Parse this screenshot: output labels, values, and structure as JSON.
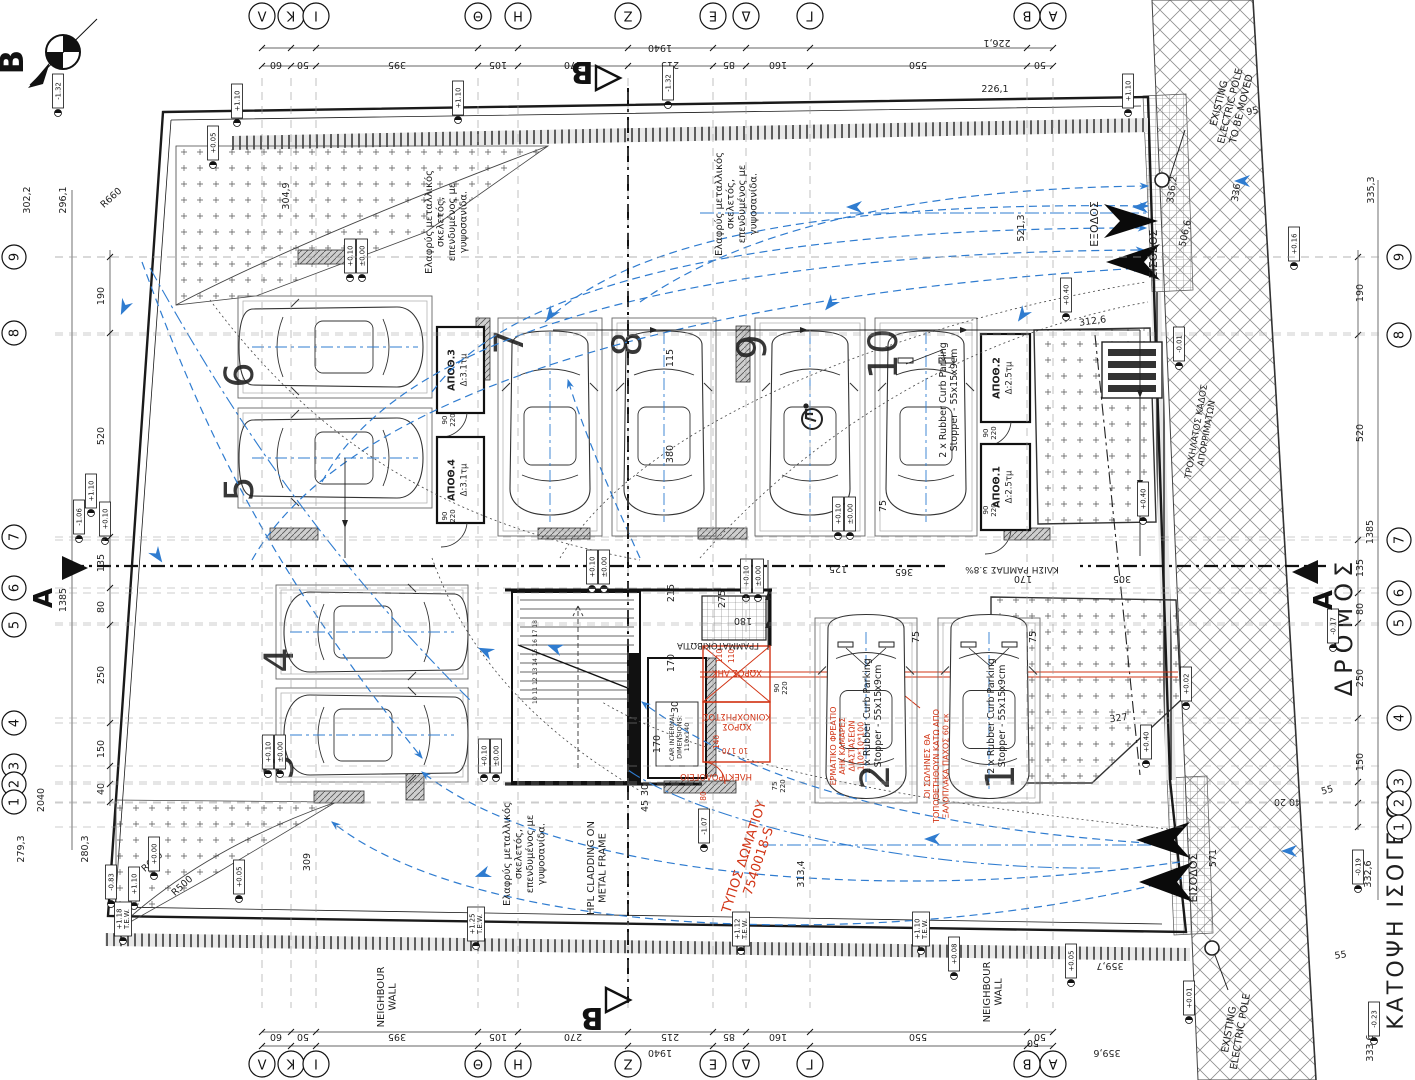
{
  "meta": {
    "drawing_title": "ΚΑΤΟΨΗ ΙΣΟΓΕΙΟΥ",
    "road_label": "ΔΡΟΜΟΣ"
  },
  "colors": {
    "ink": "#1f1f1f",
    "red": "#d23415",
    "blue": "#2f7cd0",
    "gray": "#666666",
    "paper": "#ffffff"
  },
  "markers": {
    "north": "B",
    "section_a": "A",
    "section_b": "B"
  },
  "grid": {
    "cols": [
      {
        "label": "Λ",
        "x": 262
      },
      {
        "label": "K",
        "x": 291
      },
      {
        "label": "I",
        "x": 316
      },
      {
        "label": "Θ",
        "x": 478
      },
      {
        "label": "H",
        "x": 518
      },
      {
        "label": "Z",
        "x": 628
      },
      {
        "label": "E",
        "x": 713
      },
      {
        "label": "Δ",
        "x": 746
      },
      {
        "label": "Γ",
        "x": 810
      },
      {
        "label": "B",
        "x": 1027
      },
      {
        "label": "A",
        "x": 1053
      }
    ],
    "rows_left": [
      {
        "label": "9",
        "y": 257
      },
      {
        "label": "8",
        "y": 333
      },
      {
        "label": "7",
        "y": 537
      },
      {
        "label": "6",
        "y": 588
      },
      {
        "label": "5",
        "y": 625
      },
      {
        "label": "4",
        "y": 723
      },
      {
        "label": "3",
        "y": 766
      },
      {
        "label": "2",
        "y": 784
      },
      {
        "label": "1",
        "y": 802
      }
    ],
    "rows_right": [
      {
        "label": "9",
        "y": 257
      },
      {
        "label": "8",
        "y": 335
      },
      {
        "label": "7",
        "y": 540
      },
      {
        "label": "6",
        "y": 593
      },
      {
        "label": "5",
        "y": 623
      },
      {
        "label": "4",
        "y": 718
      },
      {
        "label": "3",
        "y": 782
      },
      {
        "label": "2",
        "y": 803
      },
      {
        "label": "1",
        "y": 827
      }
    ]
  },
  "rooms": [
    {
      "label": "ΑΠΟΘ.3",
      "area": "Δ:3.1τμ",
      "x": 437,
      "y": 327,
      "w": 47,
      "h": 86
    },
    {
      "label": "ΑΠΟΘ.4",
      "area": "Δ:3.1τμ",
      "x": 437,
      "y": 437,
      "w": 47,
      "h": 86
    },
    {
      "label": "ΑΠΟΘ.2",
      "area": "Δ:2.5τμ",
      "x": 981,
      "y": 334,
      "w": 49,
      "h": 88
    },
    {
      "label": "ΑΠΟΘ.1",
      "area": "Δ:2.5τμ",
      "x": 981,
      "y": 444,
      "w": 49,
      "h": 86
    }
  ],
  "parking": {
    "stopper_note": [
      "2 x Rubber Curb Parking",
      "Stopper - 55x15x9cm"
    ],
    "stoppers": [
      {
        "x": 946,
        "y": 400,
        "cx": 926,
        "cy": 430
      },
      {
        "x": 870,
        "y": 716,
        "cx": 866,
        "cy": 714
      },
      {
        "x": 994,
        "y": 716,
        "cx": 989,
        "cy": 714
      }
    ],
    "spots": [
      {
        "n": "6",
        "x": 238,
        "y": 296,
        "w": 194,
        "h": 102,
        "o": "hl",
        "numx": 253,
        "numy": 375
      },
      {
        "n": "5",
        "x": 238,
        "y": 408,
        "w": 194,
        "h": 100,
        "o": "hl",
        "numx": 253,
        "numy": 489
      },
      {
        "n": "7",
        "x": 498,
        "y": 318,
        "w": 104,
        "h": 218,
        "o": "v",
        "numx": 523,
        "numy": 342
      },
      {
        "n": "8",
        "x": 612,
        "y": 318,
        "w": 104,
        "h": 218,
        "o": "v",
        "numx": 641,
        "numy": 344
      },
      {
        "n": "9",
        "x": 755,
        "y": 318,
        "w": 110,
        "h": 218,
        "o": "v",
        "numx": 766,
        "numy": 347,
        "accessible": true
      },
      {
        "n": "10",
        "x": 875,
        "y": 318,
        "w": 102,
        "h": 218,
        "o": "v",
        "numx": 897,
        "numy": 354
      },
      {
        "n": "4",
        "x": 276,
        "y": 585,
        "w": 192,
        "h": 94,
        "o": "hr",
        "numx": 293,
        "numy": 660
      },
      {
        "n": "3",
        "x": 276,
        "y": 688,
        "w": 192,
        "h": 94,
        "o": "hr",
        "numx": 293,
        "numy": 767
      },
      {
        "n": "2",
        "x": 815,
        "y": 618,
        "w": 102,
        "h": 185,
        "o": "v",
        "numx": 889,
        "numy": 777
      },
      {
        "n": "1",
        "x": 938,
        "y": 618,
        "w": 102,
        "h": 185,
        "o": "v",
        "numx": 1014,
        "numy": 777
      }
    ]
  },
  "flags": [
    {
      "t": "-1.32",
      "x": 58,
      "y": 113
    },
    {
      "t": "-1.32",
      "x": 668,
      "y": 105
    },
    {
      "t": "+1.10",
      "x": 237,
      "y": 123
    },
    {
      "t": "+1.10",
      "x": 458,
      "y": 120
    },
    {
      "t": "+1.10",
      "x": 1128,
      "y": 113
    },
    {
      "t": "+0.05",
      "x": 213,
      "y": 165
    },
    {
      "t": "+0.10",
      "x": 350,
      "y": 278
    },
    {
      "t": "±0.00",
      "x": 362,
      "y": 278
    },
    {
      "t": "+0.10",
      "x": 592,
      "y": 589
    },
    {
      "t": "±0.00",
      "x": 604,
      "y": 589
    },
    {
      "t": "+0.10",
      "x": 746,
      "y": 598
    },
    {
      "t": "±0.00",
      "x": 758,
      "y": 598
    },
    {
      "t": "+0.10",
      "x": 838,
      "y": 536
    },
    {
      "t": "±0.00",
      "x": 850,
      "y": 536
    },
    {
      "t": "+0.10",
      "x": 268,
      "y": 774
    },
    {
      "t": "±0.00",
      "x": 280,
      "y": 774
    },
    {
      "t": "+0.10",
      "x": 484,
      "y": 778
    },
    {
      "t": "±0.00",
      "x": 496,
      "y": 778
    },
    {
      "t": "+0.40",
      "x": 1066,
      "y": 317
    },
    {
      "t": "+0.40",
      "x": 1143,
      "y": 521
    },
    {
      "t": "+0.40",
      "x": 1146,
      "y": 764
    },
    {
      "t": "+0.16",
      "x": 1294,
      "y": 266
    },
    {
      "t": "-0.01",
      "x": 1179,
      "y": 366
    },
    {
      "t": "+0.02",
      "x": 1186,
      "y": 706
    },
    {
      "t": "-1.07",
      "x": 704,
      "y": 848
    },
    {
      "t": "-1.06",
      "x": 79,
      "y": 539
    },
    {
      "t": "+1.10",
      "x": 91,
      "y": 513
    },
    {
      "t": "+0.10",
      "x": 105,
      "y": 541
    },
    {
      "t": "-0.83",
      "x": 111,
      "y": 904
    },
    {
      "t": "+1.10",
      "x": 134,
      "y": 906
    },
    {
      "t": "+0.05",
      "x": 239,
      "y": 899
    },
    {
      "t": "+0.00",
      "x": 154,
      "y": 876
    },
    {
      "t": [
        "+1.25",
        "T.E.W."
      ],
      "x": 476,
      "y": 946
    },
    {
      "t": [
        "+1.18",
        "T.E.W."
      ],
      "x": 123,
      "y": 941
    },
    {
      "t": [
        "+1.12",
        "T.E.W."
      ],
      "x": 741,
      "y": 951
    },
    {
      "t": [
        "+1.10",
        "T.E.W."
      ],
      "x": 921,
      "y": 951
    },
    {
      "t": "+0.08",
      "x": 954,
      "y": 976
    },
    {
      "t": "-0.19",
      "x": 1358,
      "y": 889
    },
    {
      "t": "-0.23",
      "x": 1374,
      "y": 1041
    },
    {
      "t": "+0.01",
      "x": 1189,
      "y": 1020
    },
    {
      "t": "+0.05",
      "x": 1071,
      "y": 983
    },
    {
      "t": "-0.17",
      "x": 1333,
      "y": 648
    }
  ],
  "labels": [
    {
      "t": "60",
      "x": 276,
      "y": 62,
      "r": 180
    },
    {
      "t": "50",
      "x": 303,
      "y": 62,
      "r": 180
    },
    {
      "t": "395",
      "x": 397,
      "y": 62,
      "r": 180
    },
    {
      "t": "105",
      "x": 498,
      "y": 62,
      "r": 180
    },
    {
      "t": "270",
      "x": 573,
      "y": 62,
      "r": 180
    },
    {
      "t": "215",
      "x": 670,
      "y": 62,
      "r": 180
    },
    {
      "t": "85",
      "x": 729,
      "y": 62,
      "r": 180
    },
    {
      "t": "160",
      "x": 778,
      "y": 62,
      "r": 180
    },
    {
      "t": "550",
      "x": 918,
      "y": 62,
      "r": 180
    },
    {
      "t": "50",
      "x": 1040,
      "y": 62,
      "r": 180
    },
    {
      "t": "1940",
      "x": 660,
      "y": 45,
      "r": 180
    },
    {
      "t": "226,1",
      "x": 997,
      "y": 40,
      "r": 180
    },
    {
      "t": "226,1",
      "x": 995,
      "y": 92
    },
    {
      "t": "60",
      "x": 276,
      "y": 1034,
      "r": 180
    },
    {
      "t": "50",
      "x": 303,
      "y": 1034,
      "r": 180
    },
    {
      "t": "395",
      "x": 397,
      "y": 1034,
      "r": 180
    },
    {
      "t": "105",
      "x": 498,
      "y": 1034,
      "r": 180
    },
    {
      "t": "270",
      "x": 573,
      "y": 1034,
      "r": 180
    },
    {
      "t": "215",
      "x": 670,
      "y": 1034,
      "r": 180
    },
    {
      "t": "85",
      "x": 729,
      "y": 1034,
      "r": 180
    },
    {
      "t": "160",
      "x": 778,
      "y": 1034,
      "r": 180
    },
    {
      "t": "550",
      "x": 918,
      "y": 1034,
      "r": 180
    },
    {
      "t": "50",
      "x": 1040,
      "y": 1034,
      "r": 180
    },
    {
      "t": "1940",
      "x": 660,
      "y": 1050,
      "r": 180
    },
    {
      "t": "359,7",
      "x": 1110,
      "y": 963,
      "r": 180
    },
    {
      "t": "359,6",
      "x": 1107,
      "y": 1050,
      "r": 180
    },
    {
      "t": "50",
      "x": 1033,
      "y": 1040,
      "r": 180
    },
    {
      "t": "55",
      "x": 1328,
      "y": 793,
      "r": -15
    },
    {
      "t": "55",
      "x": 1341,
      "y": 958,
      "r": -8
    },
    {
      "t": "20",
      "x": 1280,
      "y": 799,
      "r": 180
    },
    {
      "t": "40",
      "x": 1295,
      "y": 799,
      "r": 180
    },
    {
      "t": "302,2",
      "x": 30,
      "y": 200,
      "r": -90
    },
    {
      "t": "296,1",
      "x": 66,
      "y": 200,
      "r": -90
    },
    {
      "t": "190",
      "x": 104,
      "y": 296,
      "r": -90
    },
    {
      "t": "520",
      "x": 104,
      "y": 436,
      "r": -90
    },
    {
      "t": "1385",
      "x": 66,
      "y": 600,
      "r": -90
    },
    {
      "t": "135",
      "x": 104,
      "y": 563,
      "r": -90
    },
    {
      "t": "80",
      "x": 104,
      "y": 607,
      "r": -90
    },
    {
      "t": "250",
      "x": 104,
      "y": 675,
      "r": -90
    },
    {
      "t": "150",
      "x": 104,
      "y": 749,
      "r": -90
    },
    {
      "t": "40",
      "x": 104,
      "y": 789,
      "r": -90
    },
    {
      "t": "2040",
      "x": 44,
      "y": 800,
      "r": -90
    },
    {
      "t": "280,3",
      "x": 88,
      "y": 849,
      "r": -90
    },
    {
      "t": "279,3",
      "x": 24,
      "y": 849,
      "r": -90
    },
    {
      "t": "309",
      "x": 310,
      "y": 862,
      "r": -90
    },
    {
      "t": "335,3",
      "x": 1374,
      "y": 190,
      "r": -90
    },
    {
      "t": "190",
      "x": 1363,
      "y": 293,
      "r": -90
    },
    {
      "t": "520",
      "x": 1363,
      "y": 433,
      "r": -90
    },
    {
      "t": "1385",
      "x": 1373,
      "y": 532,
      "r": -90
    },
    {
      "t": "135",
      "x": 1363,
      "y": 568,
      "r": -90
    },
    {
      "t": "80",
      "x": 1363,
      "y": 609,
      "r": -90
    },
    {
      "t": "250",
      "x": 1363,
      "y": 678,
      "r": -90
    },
    {
      "t": "150",
      "x": 1363,
      "y": 762,
      "r": -90
    },
    {
      "t": "332,6",
      "x": 1371,
      "y": 874,
      "r": -90
    },
    {
      "t": "333,6",
      "x": 1373,
      "y": 1048,
      "r": -90
    },
    {
      "t": "571",
      "x": 1216,
      "y": 858,
      "r": -90
    },
    {
      "t": "304,9",
      "x": 289,
      "y": 196,
      "r": -90
    },
    {
      "t": "521,3",
      "x": 1024,
      "y": 228,
      "r": -90
    },
    {
      "t": "506,6",
      "x": 1188,
      "y": 234,
      "r": -78
    },
    {
      "t": "336,2",
      "x": 1175,
      "y": 190,
      "r": -82
    },
    {
      "t": "336",
      "x": 1239,
      "y": 193,
      "r": -82
    },
    {
      "t": "95",
      "x": 1253,
      "y": 114,
      "r": -12
    },
    {
      "t": "312,6",
      "x": 1093,
      "y": 324,
      "r": -8
    },
    {
      "t": "327",
      "x": 1119,
      "y": 721,
      "r": -8
    },
    {
      "t": "305",
      "x": 1122,
      "y": 576,
      "r": 180
    },
    {
      "t": "170",
      "x": 1023,
      "y": 576,
      "r": 180
    },
    {
      "t": "365",
      "x": 904,
      "y": 569,
      "r": 180
    },
    {
      "t": "125",
      "x": 838,
      "y": 566,
      "r": 180
    },
    {
      "t": "115",
      "x": 673,
      "y": 358,
      "r": -90
    },
    {
      "t": "380",
      "x": 673,
      "y": 454,
      "r": -90
    },
    {
      "t": "75",
      "x": 886,
      "y": 506,
      "r": -90
    },
    {
      "t": "75",
      "x": 919,
      "y": 637,
      "r": -90
    },
    {
      "t": "75",
      "x": 1036,
      "y": 637,
      "r": -90
    },
    {
      "t": "215",
      "x": 674,
      "y": 593,
      "r": -90
    },
    {
      "t": "275",
      "x": 725,
      "y": 599,
      "r": -90
    },
    {
      "t": "180",
      "x": 743,
      "y": 618,
      "r": 180
    },
    {
      "t": "170",
      "x": 674,
      "y": 663,
      "r": -90
    },
    {
      "t": "30",
      "x": 678,
      "y": 707,
      "r": -90
    },
    {
      "t": "170",
      "x": 660,
      "y": 744,
      "r": -90
    },
    {
      "t": "45",
      "x": 648,
      "y": 806,
      "r": -90
    },
    {
      "t": "30",
      "x": 648,
      "y": 790,
      "r": -90
    },
    {
      "t": [
        "90",
        "220"
      ],
      "x": 447,
      "y": 420,
      "r": -90,
      "s": 7
    },
    {
      "t": [
        "90",
        "220"
      ],
      "x": 447,
      "y": 516,
      "r": -90,
      "s": 7
    },
    {
      "t": [
        "90",
        "220"
      ],
      "x": 988,
      "y": 433,
      "r": -90,
      "s": 7
    },
    {
      "t": [
        "90",
        "220"
      ],
      "x": 988,
      "y": 510,
      "r": -90,
      "s": 7
    },
    {
      "t": [
        "90",
        "220"
      ],
      "x": 779,
      "y": 688,
      "r": -90,
      "s": 7
    },
    {
      "t": [
        "75",
        "220"
      ],
      "x": 777,
      "y": 786,
      "r": -90,
      "s": 7
    },
    {
      "t": "313,4",
      "x": 804,
      "y": 874,
      "r": -90
    },
    {
      "t": "R660",
      "x": 113,
      "y": 200,
      "r": -42
    },
    {
      "t": "R600",
      "x": 154,
      "y": 864,
      "r": -42
    },
    {
      "t": "R500",
      "x": 184,
      "y": 888,
      "r": -42
    },
    {
      "t": [
        "Ελαφρύς μεταλλικός",
        "σκελετός,",
        "επενδυμένος με",
        "γυψοσανίδα."
      ],
      "x": 432,
      "y": 222,
      "r": -90,
      "s": 10,
      "n": "note-metal-frame-1"
    },
    {
      "t": [
        "Ελαφρύς μεταλλικός",
        "σκελετός,",
        "επενδυμένος με",
        "γυψοσανίδα."
      ],
      "x": 722,
      "y": 204,
      "r": -90,
      "s": 10,
      "n": "note-metal-frame-2"
    },
    {
      "t": [
        "Ελαφρύς μεταλλικός",
        "σκελετός,",
        "επενδυμένος με",
        "γυψοσανίδα."
      ],
      "x": 510,
      "y": 854,
      "r": -90,
      "s": 10,
      "n": "note-metal-frame-3"
    },
    {
      "t": [
        "HPL CLADDING ON",
        "METAL FRAME"
      ],
      "x": 594,
      "y": 868,
      "r": -90,
      "s": 10,
      "n": "note-hpl-cladding"
    },
    {
      "t": [
        "NEIGHBOUR",
        "WALL"
      ],
      "x": 384,
      "y": 997,
      "r": -90,
      "s": 10,
      "n": "note-neighbour-wall-1"
    },
    {
      "t": [
        "NEIGHBOUR",
        "WALL"
      ],
      "x": 990,
      "y": 992,
      "r": -90,
      "s": 10,
      "n": "note-neighbour-wall-2"
    },
    {
      "t": [
        "EXISTING",
        "ELECTRIC POLE",
        "TO BE MOVED"
      ],
      "x": 1222,
      "y": 104,
      "r": -76,
      "s": 10,
      "n": "note-electric-pole-moved"
    },
    {
      "t": [
        "EXISTING",
        "ELECTRIC POLE"
      ],
      "x": 1232,
      "y": 1030,
      "r": -80,
      "s": 10,
      "n": "note-electric-pole"
    },
    {
      "t": [
        "ΤΡΟΧΗΛΑΤΟΣ ΚΑΔΟΣ",
        "ΑΠΟΡΡΙΜΑΤΩΝ"
      ],
      "x": 1199,
      "y": 432,
      "r": -80,
      "s": 9,
      "n": "note-waste-bin"
    },
    {
      "t": "ΓΡΑΜΜΑΤΟΚΙΒΩΤΙΑ",
      "x": 718,
      "y": 643,
      "r": 180,
      "s": 8.5,
      "n": "label-mailboxes"
    },
    {
      "t": "ΚΛΙΣΗ ΡΑΜΠΑΣ 3.8%",
      "x": 1012,
      "y": 567,
      "r": 180,
      "s": 9,
      "n": "label-ramp-slope"
    },
    {
      "t": "ΔΡΟΜΟΣ",
      "x": 1352,
      "y": 626,
      "r": -90,
      "s": 24,
      "ls": 6,
      "n": "label-road"
    },
    {
      "t": "ΚΑΤΟΨΗ ΙΣΟΓΕΙΟΥ",
      "x": 1403,
      "y": 906,
      "r": -90,
      "s": 22,
      "ls": 3,
      "n": "drawing-title"
    },
    {
      "t": "ΕΞΟΔΟΣ",
      "x": 1098,
      "y": 224,
      "r": -90,
      "s": 11,
      "n": "label-exit"
    },
    {
      "t": "ΕΙΣΟΔΟΣ",
      "x": 1157,
      "y": 254,
      "r": -90,
      "s": 11,
      "n": "label-entrance-top"
    },
    {
      "t": "ΕΙΣΟΔΟΣ",
      "x": 1197,
      "y": 878,
      "r": -90,
      "s": 11,
      "n": "label-entrance-bottom"
    },
    {
      "t": [
        "CAR INTERNAL",
        "DIMENSIONS:",
        "110x140"
      ],
      "x": 674,
      "y": 737,
      "r": -90,
      "s": 6.5,
      "n": "label-elevator-car"
    },
    {
      "t": "10 11 12 13 14 15 16 17 18",
      "x": 537,
      "y": 662,
      "r": -90,
      "s": 6,
      "n": "label-stair-steps"
    },
    {
      "t": "ΧΩΡΟΣ ΑΗΚ",
      "x": 737,
      "y": 670,
      "r": 180,
      "s": 8.5,
      "c": "red",
      "n": "room-ahk"
    },
    {
      "t": "110",
      "x": 722,
      "y": 656,
      "r": -90,
      "s": 7.5,
      "c": "red"
    },
    {
      "t": "110",
      "x": 734,
      "y": 656,
      "r": -90,
      "s": 7.5,
      "c": "red"
    },
    {
      "t": [
        "ΧΩΡΟΣ",
        "ΚΟΙΝΟΧΡΗΣΤΟΣ"
      ],
      "x": 737,
      "y": 724,
      "r": 180,
      "s": 8.5,
      "c": "red",
      "n": "room-communal"
    },
    {
      "t": "10  170",
      "x": 735,
      "y": 748,
      "r": 180,
      "s": 7.5,
      "c": "red"
    },
    {
      "t": "ΗΛΕΚΤΡΟΛΟΓΕΙΟ",
      "x": 716,
      "y": 774,
      "r": 180,
      "s": 8.5,
      "c": "red",
      "n": "room-electrical"
    },
    {
      "t": "80",
      "x": 706,
      "y": 796,
      "r": -90,
      "s": 7.5,
      "c": "red"
    },
    {
      "t": "140",
      "x": 719,
      "y": 742,
      "r": -90,
      "s": 7.5,
      "c": "red"
    },
    {
      "t": [
        "ΕΡΜΑΤΙΚΟ ΦΡΕΑΤΙΟ",
        "ΑΗΚ ΚΑΜΑΡΕΣ",
        "ΔΙΑΣΤΑΣΕΩΝ",
        "110*10*100"
      ],
      "x": 836,
      "y": 746,
      "r": -90,
      "s": 8,
      "c": "red",
      "n": "note-ahk-duct"
    },
    {
      "t": [
        "ΟΙ ΣΩΛΗΝΕΣ ΘΑ",
        "ΤΟΠΟΘΕΤΗΘΟΥΝ ΚΑΤΩ ΑΠΟ",
        "ΞΑΛΟΠΛΑΚΑ ΠΑΧΟΣ 60 εκ"
      ],
      "x": 930,
      "y": 766,
      "r": -90,
      "s": 8,
      "c": "red",
      "n": "note-pipes"
    },
    {
      "t": [
        "ΤΥΠΟΣ ΔΩΜΑΤΙΟΥ",
        "7540018-S"
      ],
      "x": 748,
      "y": 858,
      "r": -72,
      "s": 13,
      "c": "red",
      "n": "note-room-type"
    }
  ]
}
